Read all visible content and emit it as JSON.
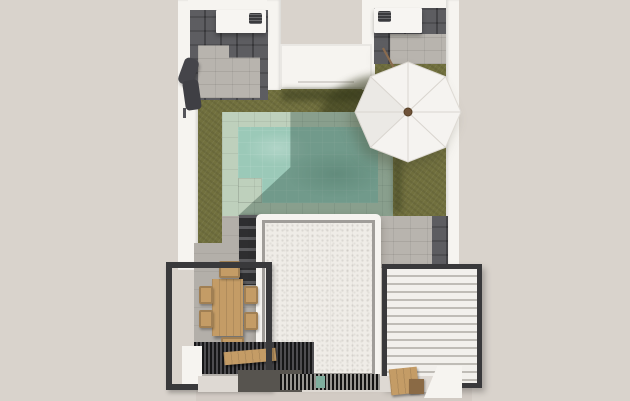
{
  "meta": {
    "type": "3d-architectural-render",
    "view": "top-down aerial",
    "subject": "villa backyard plan with swimming pool, lawn, pergolas and patio umbrella"
  },
  "palette": {
    "bg": "#d9d3cc",
    "wall": "#f6f4f0",
    "wall-shade": "#e8e4df",
    "counter": "#f7f5f2",
    "tile-dark": "#4c4c50",
    "paver": "#b8b4ae",
    "concrete": "#b3afa9",
    "grass": "#71703e",
    "grass-shadow": "#4e522a",
    "coping": "#bed0bc",
    "water": "#9bc9b8",
    "water-shadow": "#33594a",
    "roof": "#efece7",
    "roof-inset": "#a09d99",
    "frame": "#39393b",
    "louver": "#f2f0ec",
    "louver-gap": "#bfbcb6",
    "wood": "#c49c66",
    "wood-dark": "#8a6a45",
    "grill": "#3a3a3d",
    "umbrella": "#f5f3f0",
    "umbrella-rib": "#d9d5cf",
    "umbrella-hub": "#6e5238",
    "exterior-path": "#d2cbc4",
    "accent-teal": "#7fae9e"
  },
  "scene": {
    "objects": [
      {
        "name": "perimeter-wall",
        "label": "white perimeter wall"
      },
      {
        "name": "lawn",
        "label": "olive green lawn"
      },
      {
        "name": "pool",
        "label": "rectangular pool with sage stone coping and entry step"
      },
      {
        "name": "umbrella",
        "label": "white octagonal patio umbrella, tilted pole"
      },
      {
        "name": "kitchen-counter-left",
        "label": "outdoor counter with barbecue, top-left courtyard"
      },
      {
        "name": "kitchen-counter-right",
        "label": "outdoor counter with barbecue, top-right courtyard"
      },
      {
        "name": "entry-roof",
        "label": "small flat-roofed entry volume, top centre"
      },
      {
        "name": "main-roof",
        "label": "large white textured flat roof of the house"
      },
      {
        "name": "garden-stairs",
        "label": "dark steps beside the roof"
      },
      {
        "name": "dining-pergola",
        "label": "dark open pergola frame with wooden dining table and six chairs"
      },
      {
        "name": "slatted-deck",
        "label": "dark slatted deck with wooden bench"
      },
      {
        "name": "louvered-pergola",
        "label": "white louvered bioclimatic pergola, right side"
      },
      {
        "name": "entrance-grate",
        "label": "striped drainage grate at the bottom"
      },
      {
        "name": "lounge-chair",
        "label": "dark folded lounge chair against left wall"
      }
    ]
  }
}
